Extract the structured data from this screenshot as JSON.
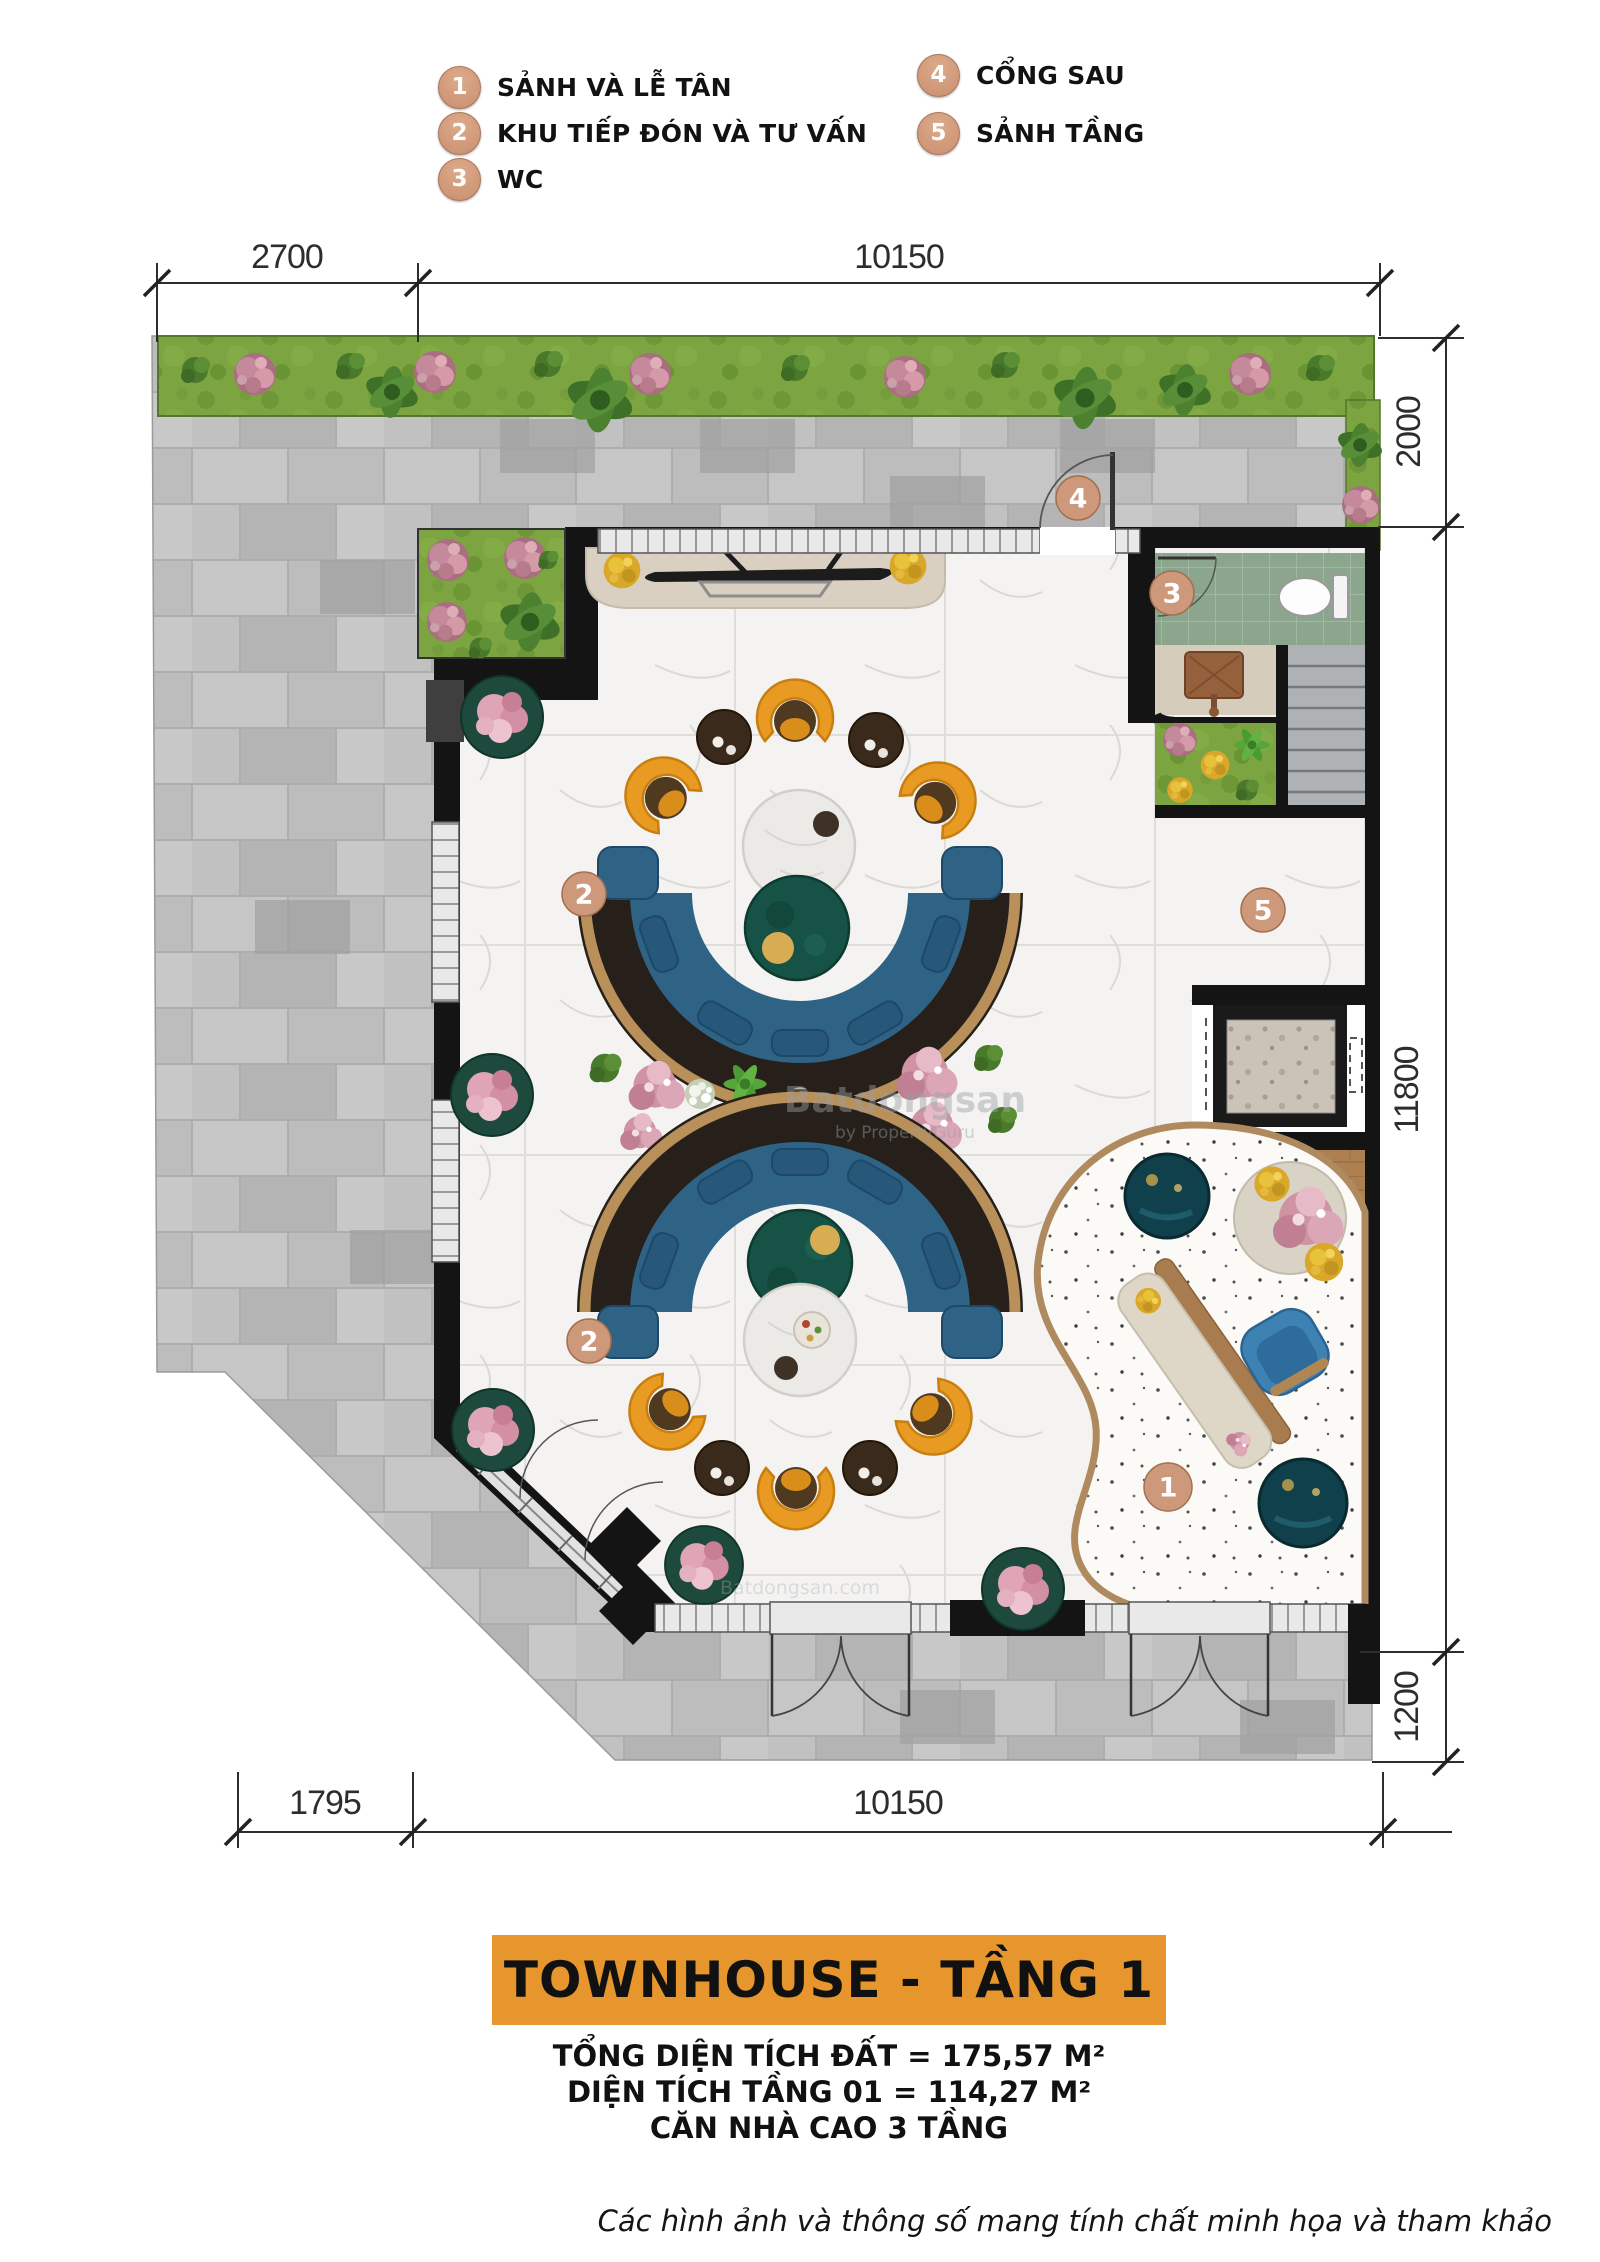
{
  "legend": {
    "items": [
      {
        "num": "1",
        "label": "SẢNH VÀ LỄ TÂN"
      },
      {
        "num": "2",
        "label": "KHU TIẾP ĐÓN VÀ TƯ VẤN"
      },
      {
        "num": "3",
        "label": "WC"
      },
      {
        "num": "4",
        "label": "CỔNG SAU"
      },
      {
        "num": "5",
        "label": "SẢNH TẦNG"
      }
    ]
  },
  "dimensions": {
    "top_left": "2700",
    "top_right": "10150",
    "right_top": "2000",
    "right_middle": "11800",
    "right_bottom": "1200",
    "bottom_left": "1795",
    "bottom_right": "10150"
  },
  "plan": {
    "markers": {
      "lobby": "1",
      "consult_top": "2",
      "consult_bottom": "2",
      "wc": "3",
      "back_gate": "4",
      "floor_hall": "5"
    }
  },
  "watermark": {
    "brand": "Batdongsan",
    "byline": "by PropertyGuru",
    "small_mark": "Batdongsan.com"
  },
  "title_block": {
    "title": "TOWNHOUSE - TẦNG 1",
    "total_area": "TỔNG DIỆN TÍCH ĐẤT = 175,57 M²",
    "floor_area": "DIỆN TÍCH TẦNG 01 = 114,27 M²",
    "height_note": "CĂN NHÀ CAO 3 TẦNG"
  },
  "footer": {
    "disclaimer": "Các hình ảnh và thông số mang tính chất minh họa và tham khảo"
  },
  "colors": {
    "accent_orange": "#E7962D",
    "marker_fill": "#CE997B",
    "sofa_blue": "#2E6385",
    "chair_orange": "#E89A22",
    "grass_green": "#7CA440",
    "wc_tile_green": "#8CA68E",
    "wood": "#AD8050",
    "paver_gray": "#BFBFBF"
  }
}
